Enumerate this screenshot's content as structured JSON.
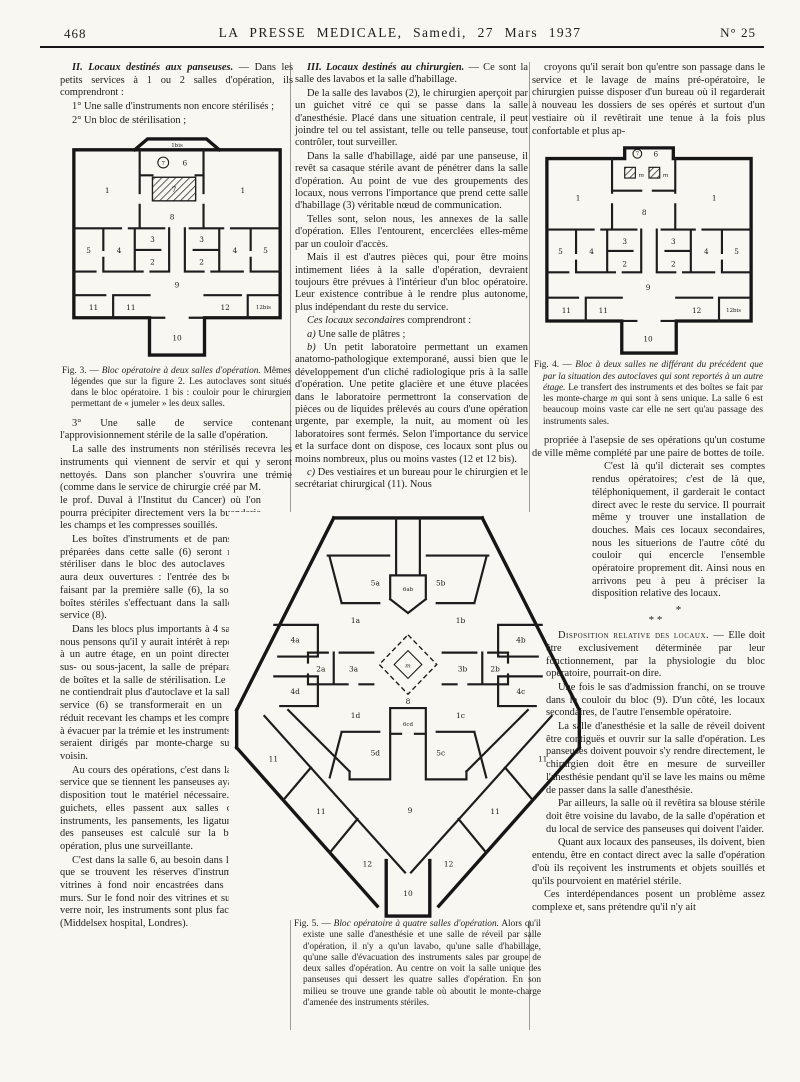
{
  "header": {
    "page_number": "468",
    "title": "LA PRESSE MEDICALE, Samedi, 27 Mars 1937",
    "issue": "N° 25"
  },
  "col1": {
    "sec2_lead": "II. Locaux destinés aux panseuses.",
    "sec2_rest": " — Dans les petits services à 1 ou 2 salles d'opération, ils comprendront :",
    "item1": "1° Une salle d'instruments non encore stérilisés ;",
    "item2": "2° Un bloc de stérilisation ;",
    "fig3_caption": {
      "lead": "Fig. 3. — ",
      "title": "Bloc opératoire à deux salles d'opération.",
      "rest": " Mêmes légendes que sur la figure 2. Les autoclaves sont situés dans le bloc opératoire. 1 bis : couloir pour le chirurgien permettant de « jumeler » les deux salles."
    },
    "p4": "3° Une salle de service contenant l'approvisionnement stérile de la salle d'opération.",
    "p5": "La salle des instruments non stérilisés recevra les instruments qui viennent de servir et qui y seront nettoyés. Dans son plancher s'ouvrira une trémie (comme dans le service de chirurgie créé par M. le prof. Duval à l'Institut du Cancer) où l'on pourra précipiter directement vers la buanderie les champs et les compresses souillés.",
    "p6": "Les boîtes d'instruments et de pansements préparées dans cette salle (6) seront mises à stériliser dans le bloc des autoclaves (7) qui aura deux ouvertures : l'entrée des boîtes se faisant par la première salle (6), la sortie des boîtes stériles s'effectuant dans la salle de service (8).",
    "p7": "Dans les blocs plus importants à 4 salles, nous pensons qu'il y aurait intérêt à reporter à un autre étage, en un point directement sus- ou sous-jacent, la salle de préparation de boîtes et la salle de stérilisation. Le bloc ne contiendrait plus d'autoclave et la salle de service (6) se transformerait en un petit réduit recevant les champs et les compresses à évacuer par la trémie et les instruments qui seraient dirigés par monte-charge sur l'étage voisin.",
    "p8": "Au cours des opérations, c'est dans la salle de service que se tiennent les panseuses ayant à leur disposition tout le matériel nécessaire. Par des guichets, elles passent aux salles d'opération les instruments, les pansements, les ligatures. La nombre des panseuses est calculé sur la base d'une par opération, plus une surveillante.",
    "p9": "C'est dans la salle 6, au besoin dans les salles 6 et 8, que se trouvent les réserves d'instruments dans des vitrines à fond noir encastrées dans l'épaisseur des murs. Sur le fond noir des vitrines et sur les rayons en verre noir, les instruments sont plus faciles à identifier (Middelsex hospital, Londres)."
  },
  "col2": {
    "sec3_lead": "III. Locaux destinés au chirurgien.",
    "sec3_rest": " — Ce sont la salle des lavabos et la salle d'habillage.",
    "p2": "De la salle des lavabos (2), le chirurgien aperçoit par un guichet vitré ce qui se passe dans la salle d'anesthésie. Placé dans une situation centrale, il peut joindre tel ou tel assistant, telle ou telle panseuse, tout contrôler, tout surveiller.",
    "p3": "Dans la salle d'habillage, aidé par une panseuse, il revêt sa casaque stérile avant de pénétrer dans la salle d'opération. Au point de vue des groupements des locaux, nous verrons l'importance que prend cette salle d'habillage (3) véritable nœud de communication.",
    "p4": "Telles sont, selon nous, les annexes de la salle d'opération. Elles l'entourent, encerclées elles-même par un couloir d'accès.",
    "p5": "Mais il est d'autres pièces qui, pour être moins intimement liées à la salle d'opération, devraient toujours être prévues à l'intérieur d'un bloc opératoire. Leur existence contribue à le rendre plus autonome, plus indépendant du reste du service.",
    "p6_lead": "Ces locaux secondaires",
    "p6_rest": " comprendront :",
    "pa_lead": "a)",
    "pa_rest": " Une salle de plâtres ;",
    "pb_lead": "b)",
    "pb_rest": " Un petit laboratoire permettant un examen anatomo-pathologique extemporané, aussi bien que le développement d'un cliché radiologique pris à la salle d'opération. Une petite glacière et une étuve placées dans le laboratoire permettront la conservation de pièces ou de liquides prélevés au cours d'une opération urgente, par exemple, la nuit, au moment où les laboratoires sont fermés. Selon l'importance du service et la surface dont on dispose, ces locaux sont plus ou moins nombreux, plus ou moins vastes (12 et 12 bis).",
    "pc_lead": "c)",
    "pc_rest": " Des vestiaires et un bureau pour le chirurgien et le secrétariat chirurgical (11). Nous",
    "fig5_caption": {
      "lead": "Fig. 5. — ",
      "title": "Bloc opératoire à quatre salles d'opération.",
      "rest": " Alors qu'il existe une salle d'anesthésie et une salle de réveil par salle d'opération, il n'y a qu'un lavabo, qu'une salle d'habillage, qu'une salle d'évacuation des instruments sales par groupe de deux salles d'opération. Au centre on voit la salle unique des panseuses qui dessert les quatre salles d'opération. En son milieu se trouve une grande table où aboutit le monte-charge d'amenée des instruments stériles."
    }
  },
  "col3": {
    "p1": "croyons qu'il serait bon qu'entre son passage dans le service et le lavage de mains pré-opératoire, le chirurgien puisse disposer d'un bureau où il regarderait à nouveau les dossiers de ses opérés et surtout d'un vestiaire où il revêtirait une tenue à la fois plus confortable et plus ap-",
    "fig4_caption": {
      "lead": "Fig. 4. — ",
      "title": "Bloc à deux salles ne différant du précédent que par la situation des autoclaves qui sont reportés à un autre étage.",
      "rest1": " Le transfert des instruments et des boîtes se fait par les monte-charge ",
      "m": "m",
      "rest2": " qui sont à sens unique. La salle 6 est beaucoup moins vaste car elle ne sert qu'au passage des instruments sales."
    },
    "p2": "propriée à l'asepsie de ses opérations qu'un costume de ville même complété par une paire de bottes de toile.",
    "p3": "C'est là qu'il dicterait ses comptes rendus opératoires; c'est de là que, téléphoniquement, il garderait le contact direct avec le reste du service. Il pourrait même y trouver une installation de douches. Mais ces locaux secondaires, nous les situerions de l'autre côté du couloir qui encercle l'ensemble opératoire proprement dit. Ainsi nous en arrivons peu à peu à préciser la disposition relative des locaux.",
    "asterism_top": "*",
    "asterism_bottom": "*  *",
    "p4_lead": "Disposition relative des locaux. — ",
    "p4_rest": "Elle doit être exclusivement déterminée par leur fonctionnement, par la physiologie du bloc opératoire, pourrait-on dire.",
    "p5": "Une fois le sas d'admission franchi, on se trouve dans le couloir du bloc (9). D'un côté, les locaux secondaires, de l'autre l'ensemble opératoire.",
    "p6": "La salle d'anesthésie et la salle de réveil doivent être contiguës et ouvrir sur la salle d'opération. Les panseuses doivent pouvoir s'y rendre directement, le chirurgien doit être en mesure de surveiller l'anesthésie pendant qu'il se lave les mains ou même de passer dans la salle d'anesthésie.",
    "p7": "Par ailleurs, la salle où il revêtira sa blouse stérile doit être voisine du lavabo, de la salle d'opération et du local de service des panseuses qui doivent l'aider.",
    "p8": "Quant aux locaux des panseuses, ils doivent, bien entendu, être en contact direct avec la salle d'opération d'où ils reçoivent les instruments et objets souillés et qu'ils pourvoient en matériel stérile.",
    "p9": "Ces interdépendances posent un problème assez complexe et, sans prétendre qu'il n'y ait"
  },
  "figures": {
    "fig3": {
      "labels": [
        "1bis",
        "7",
        "6",
        "7",
        "8",
        "1",
        "1",
        "3",
        "3",
        "2",
        "2",
        "4",
        "4",
        "5",
        "5",
        "9",
        "11",
        "11",
        "12",
        "12bis",
        "10"
      ]
    },
    "fig4": {
      "labels": [
        "7",
        "6",
        "m",
        "m",
        "8",
        "1",
        "1",
        "3",
        "3",
        "2",
        "2",
        "4",
        "4",
        "5",
        "5",
        "9",
        "11",
        "11",
        "12",
        "12bis",
        "10"
      ]
    },
    "fig5": {
      "labels": [
        "5a",
        "5b",
        "6ab",
        "1a",
        "1b",
        "4a",
        "2a",
        "3a",
        "3b",
        "2b",
        "4b",
        "m",
        "8",
        "6cd",
        "1d",
        "1c",
        "4d",
        "4c",
        "5d",
        "5c",
        "9",
        "11",
        "11",
        "12",
        "11",
        "11",
        "12",
        "10"
      ]
    }
  },
  "colors": {
    "ink": "#1e1e1e",
    "paper": "#f8f7f1",
    "rule": "#9a9a96"
  }
}
